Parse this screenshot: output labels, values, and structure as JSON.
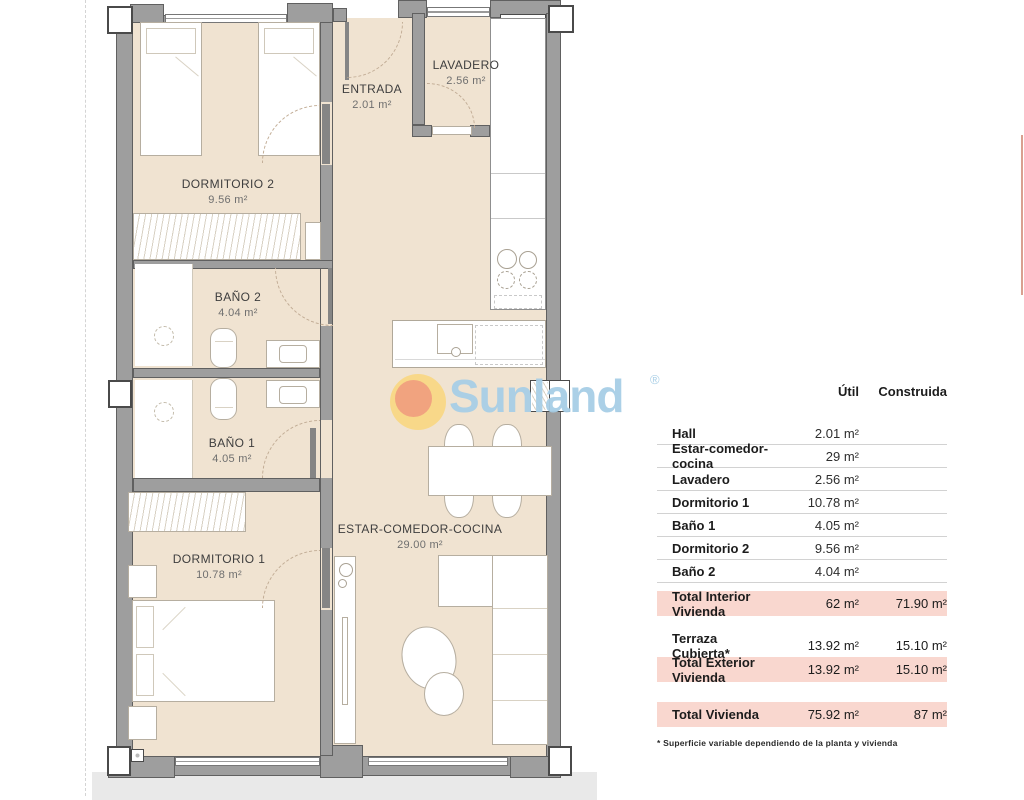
{
  "logo": {
    "text": "Sunland",
    "registered": "®",
    "colors": {
      "word_blue": "#a7cee6",
      "sun_yellow": "#fbd46e",
      "sun_core": "#ee947c"
    }
  },
  "plan": {
    "colors": {
      "room_fill": "#f0e3d1",
      "wall_gray": "#9e9e9e",
      "terrace_gray": "#e9e9e9"
    },
    "rooms": [
      {
        "name": "DORMITORIO 2",
        "area": "9.56 m²"
      },
      {
        "name": "ENTRADA",
        "area": "2.01 m²"
      },
      {
        "name": "LAVADERO",
        "area": "2.56 m²"
      },
      {
        "name": "BAÑO 2",
        "area": "4.04 m²"
      },
      {
        "name": "BAÑO 1",
        "area": "4.05 m²"
      },
      {
        "name": "DORMITORIO 1",
        "area": "10.78 m²"
      },
      {
        "name": "ESTAR-COMEDOR-COCINA",
        "area": "29.00 m²"
      }
    ]
  },
  "table": {
    "highlight_color": "#f9d7cf",
    "headers": {
      "util": "Útil",
      "construida": "Construida"
    },
    "rows": [
      {
        "label": "Hall",
        "util": "2.01 m²",
        "construida": ""
      },
      {
        "label": "Estar-comedor-cocina",
        "util": "29 m²",
        "construida": ""
      },
      {
        "label": "Lavadero",
        "util": "2.56 m²",
        "construida": ""
      },
      {
        "label": "Dormitorio 1",
        "util": "10.78 m²",
        "construida": ""
      },
      {
        "label": "Baño 1",
        "util": "4.05 m²",
        "construida": ""
      },
      {
        "label": "Dormitorio 2",
        "util": "9.56 m²",
        "construida": ""
      },
      {
        "label": "Baño 2",
        "util": "4.04 m²",
        "construida": ""
      }
    ],
    "total_interior": {
      "label": "Total Interior Vivienda",
      "util": "62 m²",
      "construida": "71.90 m²"
    },
    "terraza": {
      "label": "Terraza Cubierta*",
      "util": "13.92 m²",
      "construida": "15.10 m²"
    },
    "total_exterior": {
      "label": "Total Exterior Vivienda",
      "util": "13.92 m²",
      "construida": "15.10 m²"
    },
    "total_vivienda": {
      "label": "Total Vivienda",
      "util": "75.92 m²",
      "construida": "87 m²"
    },
    "footnote": "* Superficie variable dependiendo de la planta y vivienda"
  }
}
